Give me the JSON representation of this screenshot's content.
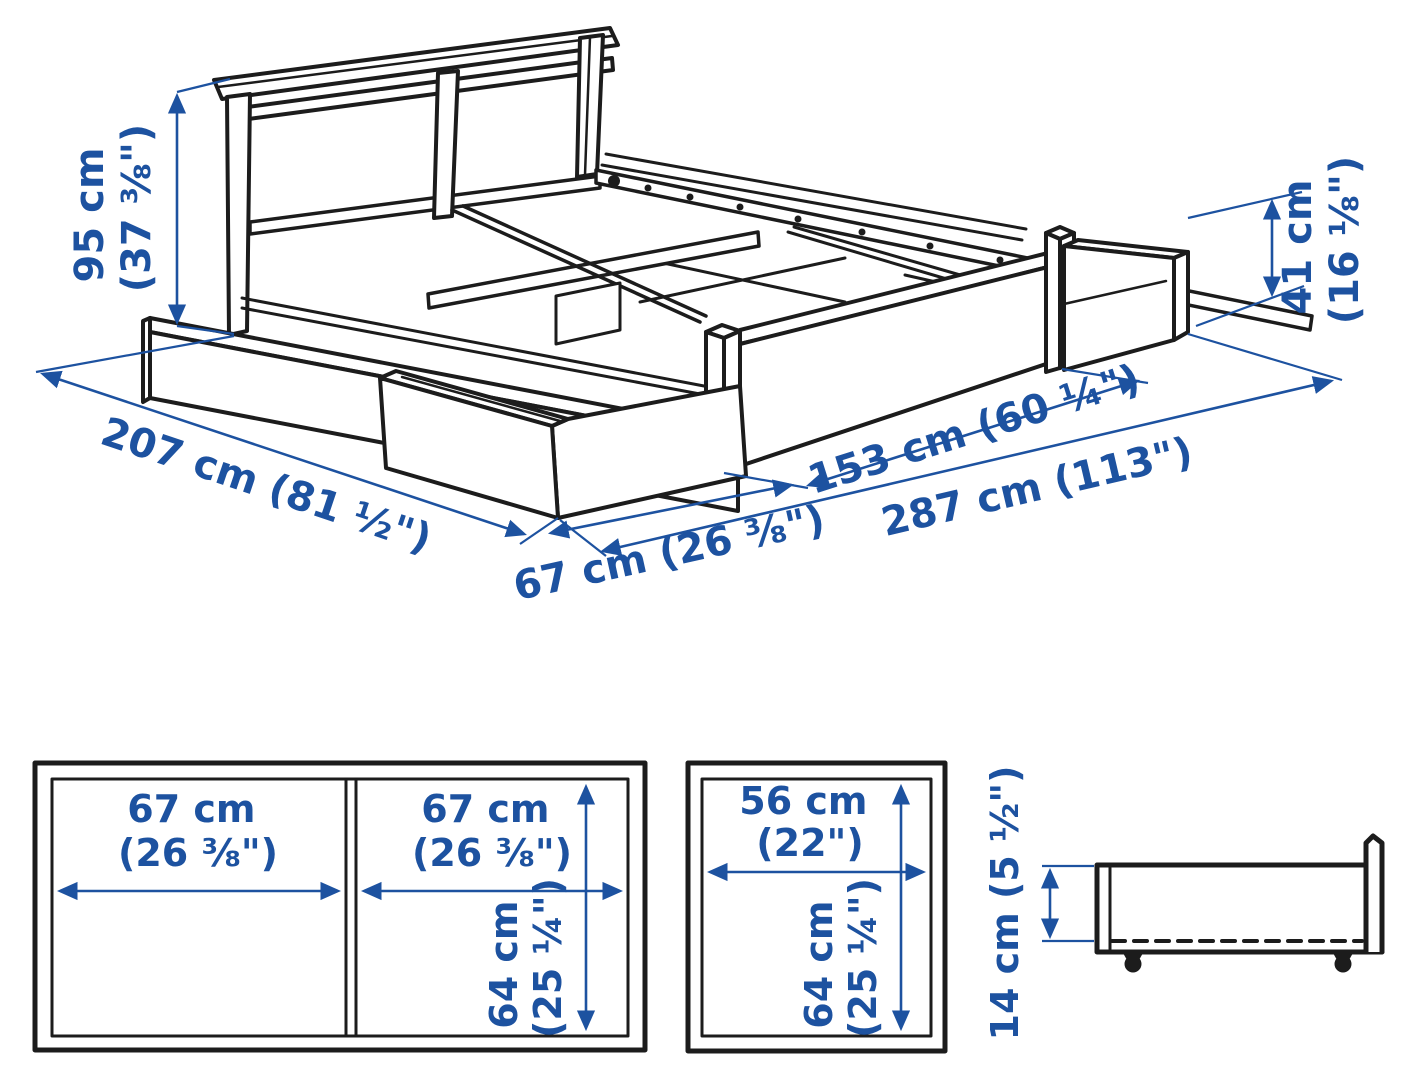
{
  "accent_color": "#1d52a0",
  "line_color": "#1c1c1c",
  "dims": {
    "headboard_height": {
      "cm": "95 cm",
      "inch": "(37 ⅜\")"
    },
    "side_height": {
      "cm": "41 cm",
      "inch": "(16 ⅛\")"
    },
    "bed_length": "207 cm (81 ½\")",
    "drawer_extension": "67 cm (26 ⅜\")",
    "bed_width": "153 cm (60 ¼\")",
    "total_clearance_width": "287 cm (113\")"
  },
  "top_view_double_drawer": {
    "left_width_cm": "67 cm",
    "left_width_in": "(26 ⅜\")",
    "right_width_cm": "67 cm",
    "right_width_in": "(26 ⅜\")",
    "depth_cm": "64 cm",
    "depth_in": "(25 ¼\")"
  },
  "top_view_single_drawer": {
    "width_cm": "56 cm",
    "width_in": "(22\")",
    "depth_cm": "64 cm",
    "depth_in": "(25 ¼\")"
  },
  "side_view_drawer": {
    "height": "14 cm (5 ½\")"
  }
}
